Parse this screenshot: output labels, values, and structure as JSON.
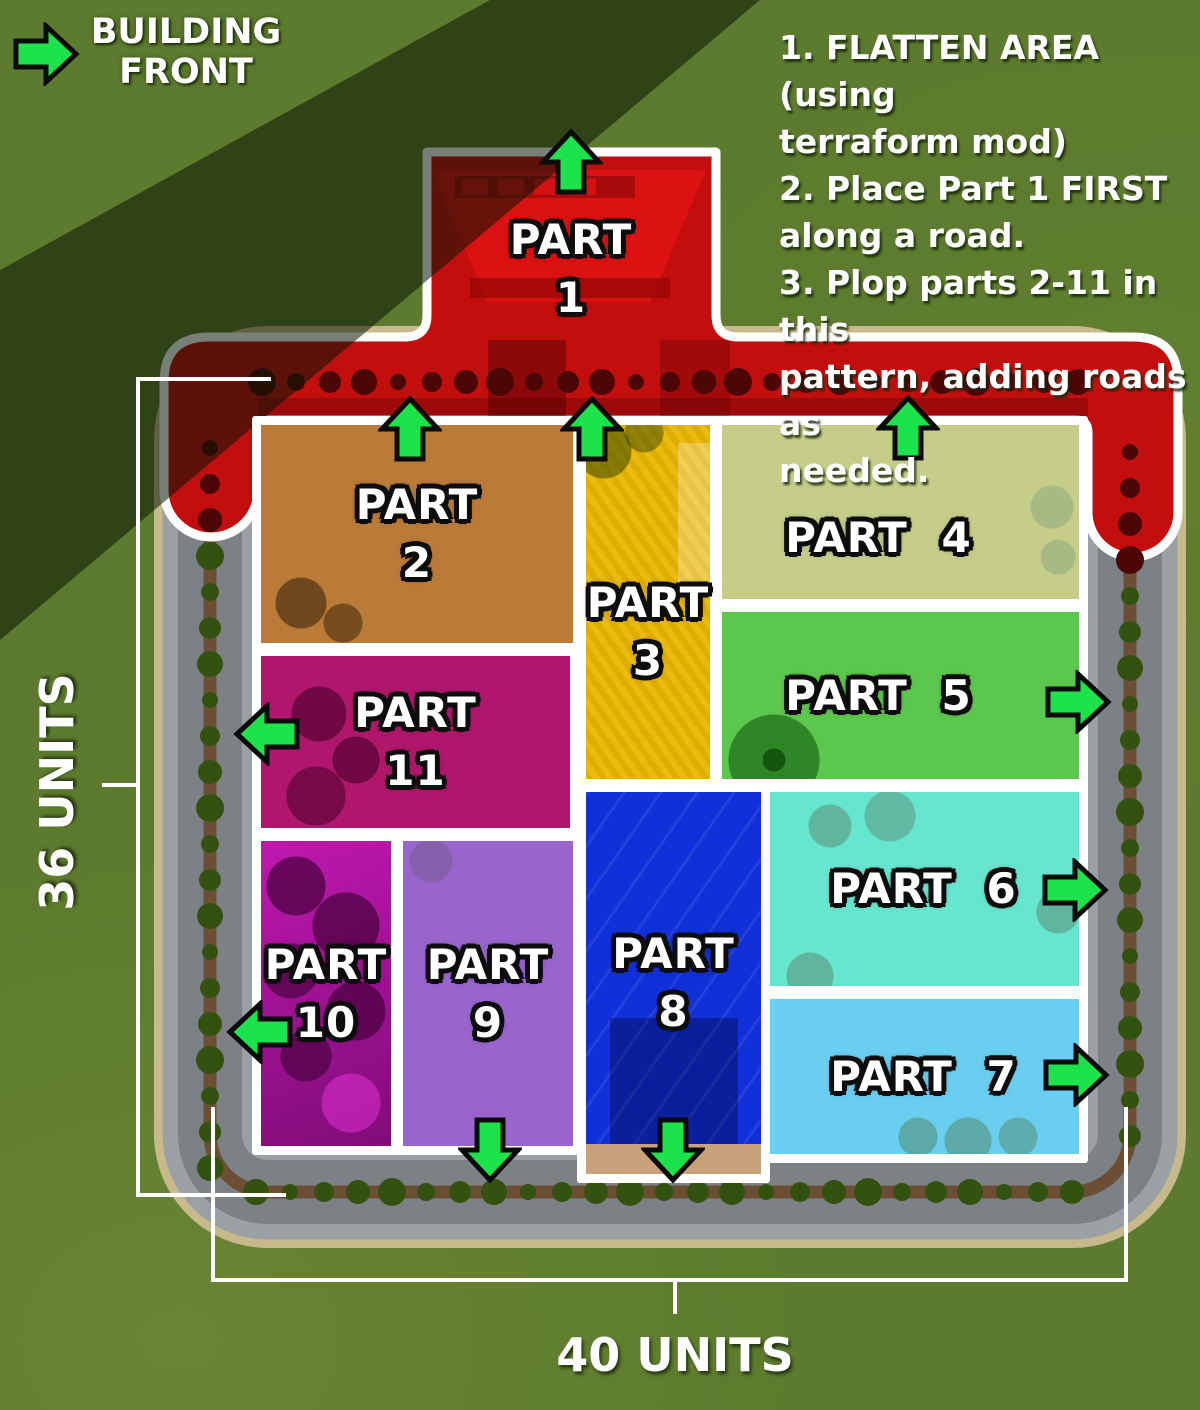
{
  "legend": {
    "label": "BUILDING FRONT"
  },
  "instructions": {
    "lines": [
      "1. FLATTEN AREA (using",
      "terraform mod)",
      "2. Place Part 1 FIRST",
      "along a road.",
      "3. Plop parts 2-11 in this",
      "pattern, adding roads as",
      "needed."
    ]
  },
  "parts": [
    {
      "word": "PART",
      "number": "1",
      "front_direction": "up",
      "color": "#c30e0e"
    },
    {
      "word": "PART",
      "number": "2",
      "front_direction": "up",
      "color": "#ef7d02"
    },
    {
      "word": "PART",
      "number": "3",
      "front_direction": "up",
      "color": "#eab703"
    },
    {
      "word": "PART",
      "number": "4",
      "front_direction": "up",
      "color": "#cfe51d"
    },
    {
      "word": "PART",
      "number": "5",
      "front_direction": "right",
      "color": "#2bd414"
    },
    {
      "word": "PART",
      "number": "6",
      "front_direction": "right",
      "color": "#15d9b5"
    },
    {
      "word": "PART",
      "number": "7",
      "front_direction": "right",
      "color": "#29b9e9"
    },
    {
      "word": "PART",
      "number": "8",
      "front_direction": "down",
      "color": "#1130da"
    },
    {
      "word": "PART",
      "number": "9",
      "front_direction": "down",
      "color": "#7b16de"
    },
    {
      "word": "PART",
      "number": "10",
      "front_direction": "left",
      "color": "#9c0f92"
    },
    {
      "word": "PART",
      "number": "11",
      "front_direction": "left",
      "color": "#f50c8c"
    }
  ],
  "dimensions": {
    "height_label": "36 UNITS",
    "width_label": "40 UNITS"
  },
  "colors": {
    "grass": "#5d7b2e",
    "grass_shadow": "#223a12",
    "sidewalk": "#9ba0a4",
    "asphalt": "#7c8186",
    "median_dirt": "#6b4e33",
    "road_fringe": "#c7b98c",
    "tree_green": "#33520f",
    "tree_dark_red": "#4c0606",
    "arrow_green": "#1ce24b",
    "outline_white": "#ffffff"
  }
}
